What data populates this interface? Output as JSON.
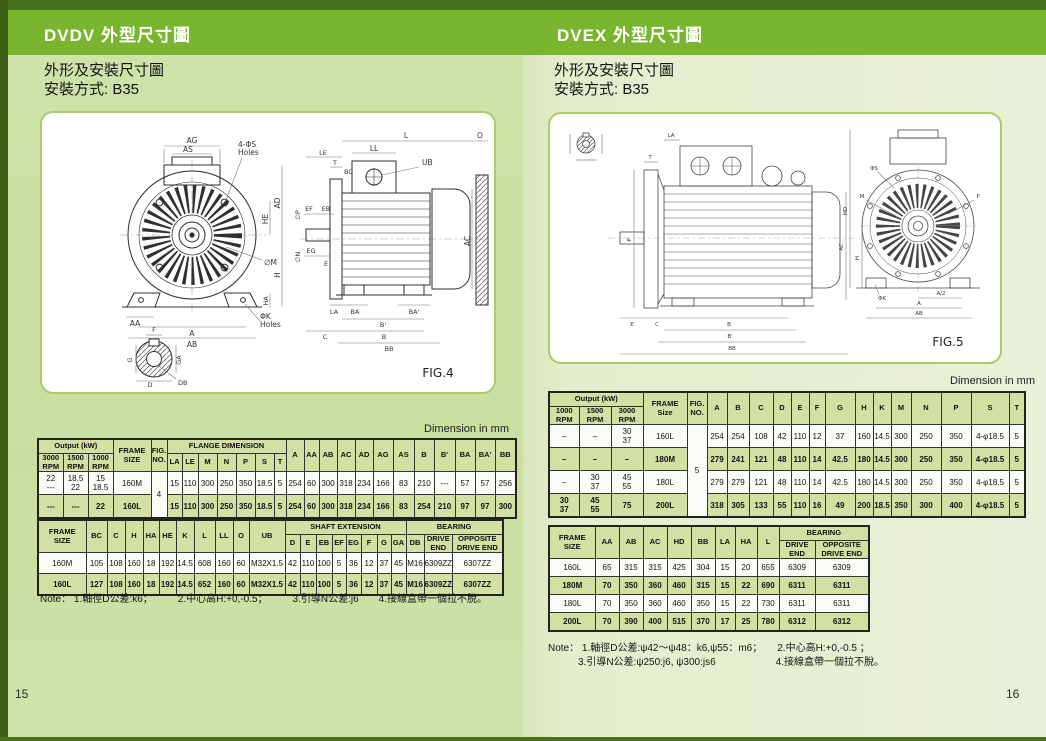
{
  "page_left": {
    "tab_title": "DVDV  外型尺寸圖",
    "subtitle_line1": "外形及安裝尺寸圖",
    "subtitle_line2": "安裝方式: B35",
    "dimension_unit": "Dimension in mm",
    "page_number": "15",
    "note": "Note： 1.軸徑D公差:k6；　　　2.中心高H:+0,-0.5；　　　3.引導N公差:j6　　4.接線盒帶一個拉不脫。",
    "fig": {
      "caption": "FIG.4",
      "ag": "AG",
      "as": "AS",
      "s_holes1": "4-ΦS",
      "s_holes2": "Holes",
      "he": "HE",
      "ad": "AD",
      "m_dia": "∅M",
      "ha": "HA",
      "h": "H",
      "aa": "AA",
      "a": "A",
      "ab": "AB",
      "k_holes1": "ΦK",
      "k_holes2": "Holes",
      "l": "L",
      "o": "O",
      "ll": "LL",
      "ub": "UB",
      "bc": "BC",
      "le": "LE",
      "t": "T",
      "p_dia": "∅P",
      "n_dia": "∅N",
      "ef": "EF",
      "eb": "EB",
      "eg": "EG",
      "e": "E",
      "ac": "AC",
      "la": "LA",
      "ba": "BA",
      "ba2": "BA'",
      "b2": "B'",
      "b": "B",
      "c": "C",
      "bb": "BB",
      "f": "F",
      "g": "G",
      "ga": "GA",
      "d": "D",
      "db": "DB"
    },
    "table1": {
      "header_rows": [
        [
          {
            "t": "Output (kW)",
            "cs": 3
          },
          {
            "t": "FRAME\nSIZE",
            "rs": 2
          },
          {
            "t": "FIG.\nNO.",
            "rs": 2
          },
          {
            "t": "FLANGE DIMENSION",
            "cs": 7
          },
          {
            "t": "A",
            "rs": 2
          },
          {
            "t": "AA",
            "rs": 2
          },
          {
            "t": "AB",
            "rs": 2
          },
          {
            "t": "AC",
            "rs": 2
          },
          {
            "t": "AD",
            "rs": 2
          },
          {
            "t": "AG",
            "rs": 2
          },
          {
            "t": "AS",
            "rs": 2
          },
          {
            "t": "B",
            "rs": 2
          },
          {
            "t": "B'",
            "rs": 2
          },
          {
            "t": "BA",
            "rs": 2
          },
          {
            "t": "BA'",
            "rs": 2
          },
          {
            "t": "BB",
            "rs": 2
          }
        ],
        [
          {
            "t": "3000\nRPM"
          },
          {
            "t": "1500\nRPM"
          },
          {
            "t": "1000\nRPM"
          },
          {
            "t": "LA"
          },
          {
            "t": "LE"
          },
          {
            "t": "M"
          },
          {
            "t": "N"
          },
          {
            "t": "P"
          },
          {
            "t": "S"
          },
          {
            "t": "T"
          }
        ]
      ],
      "rows": [
        {
          "shade": false,
          "cells": [
            "22\n---",
            "18.5\n22",
            "15\n18.5",
            "160M",
            {
              "t": "4",
              "rs": 2
            },
            "15",
            "110",
            "300",
            "250",
            "350",
            "18.5",
            "5",
            "254",
            "60",
            "300",
            "318",
            "234",
            "166",
            "83",
            "210",
            "---",
            "57",
            "57",
            "256"
          ]
        },
        {
          "shade": true,
          "cells": [
            "---",
            "---",
            "22",
            "160L",
            "15",
            "110",
            "300",
            "250",
            "350",
            "18.5",
            "5",
            "254",
            "60",
            "300",
            "318",
            "234",
            "166",
            "83",
            "254",
            "210",
            "97",
            "97",
            "300"
          ]
        }
      ]
    },
    "table2": {
      "header_rows": [
        [
          {
            "t": "FRAME\nSIZE",
            "rs": 2
          },
          {
            "t": "BC",
            "rs": 2
          },
          {
            "t": "C",
            "rs": 2
          },
          {
            "t": "H",
            "rs": 2
          },
          {
            "t": "HA",
            "rs": 2
          },
          {
            "t": "HE",
            "rs": 2
          },
          {
            "t": "K",
            "rs": 2
          },
          {
            "t": "L",
            "rs": 2
          },
          {
            "t": "LL",
            "rs": 2
          },
          {
            "t": "O",
            "rs": 2
          },
          {
            "t": "UB",
            "rs": 2
          },
          {
            "t": "SHAFT  EXTENSION",
            "cs": 8
          },
          {
            "t": "BEARING",
            "cs": 3
          }
        ],
        [
          {
            "t": "D"
          },
          {
            "t": "E"
          },
          {
            "t": "EB"
          },
          {
            "t": "EF"
          },
          {
            "t": "EG"
          },
          {
            "t": "F"
          },
          {
            "t": "G"
          },
          {
            "t": "GA"
          },
          {
            "t": "DB"
          },
          {
            "t": "DRIVE\nEND"
          },
          {
            "t": "OPPOSITE\nDRIVE  END"
          }
        ]
      ],
      "rows": [
        {
          "shade": false,
          "cells": [
            "160M",
            "105",
            "108",
            "160",
            "18",
            "192",
            "14.5",
            "608",
            "160",
            "60",
            "M32X1.5",
            "42",
            "110",
            "100",
            "5",
            "36",
            "12",
            "37",
            "45",
            "M16",
            "6309ZZ",
            "6307ZZ"
          ]
        },
        {
          "shade": true,
          "cells": [
            "160L",
            "127",
            "108",
            "160",
            "18",
            "192",
            "14.5",
            "652",
            "160",
            "60",
            "M32X1.5",
            "42",
            "110",
            "100",
            "5",
            "36",
            "12",
            "37",
            "45",
            "M16",
            "6309ZZ",
            "6307ZZ"
          ]
        }
      ]
    }
  },
  "page_right": {
    "tab_title": "DVEX  外型尺寸圖",
    "subtitle_line1": "外形及安裝尺寸圖",
    "subtitle_line2": "安裝方式: B35",
    "dimension_unit": "Dimension in mm",
    "page_number": "16",
    "note": "Note： 1.軸徑D公差:ψ42～ψ48：k6,ψ55：m6；　　2.中心高H:+0,-0.5 ；\n　　　3.引導N公差:ψ250:j6, ψ300:js6　　　　　　4.接線盒帶一個拉不脫。",
    "fig": {
      "caption": "FIG.5",
      "t": "T",
      "la": "LA",
      "p": "P",
      "ac": "AC",
      "e": "E",
      "c": "C",
      "b": "B",
      "b2": "B'",
      "bb": "BB",
      "l": "L",
      "s_dia": "ΦS",
      "m": "M",
      "p2": "P",
      "hd": "HD",
      "h": "H",
      "k_dia": "ΦK",
      "a_half": "A/2",
      "a": "A",
      "ab": "AB"
    },
    "table1": {
      "header_rows": [
        [
          {
            "t": "Output (kW)",
            "cs": 3
          },
          {
            "t": "FRAME\nSize",
            "rs": 2
          },
          {
            "t": "FIG.\nNO.",
            "rs": 2
          },
          {
            "t": "A",
            "rs": 2
          },
          {
            "t": "B",
            "rs": 2
          },
          {
            "t": "C",
            "rs": 2
          },
          {
            "t": "D",
            "rs": 2
          },
          {
            "t": "E",
            "rs": 2
          },
          {
            "t": "F",
            "rs": 2
          },
          {
            "t": "G",
            "rs": 2
          },
          {
            "t": "H",
            "rs": 2
          },
          {
            "t": "K",
            "rs": 2
          },
          {
            "t": "M",
            "rs": 2
          },
          {
            "t": "N",
            "rs": 2
          },
          {
            "t": "P",
            "rs": 2
          },
          {
            "t": "S",
            "rs": 2
          },
          {
            "t": "T",
            "rs": 2
          }
        ],
        [
          {
            "t": "1000\nRPM"
          },
          {
            "t": "1500\nRPM"
          },
          {
            "t": "3000\nRPM"
          }
        ]
      ],
      "rows": [
        {
          "shade": false,
          "cells": [
            "–",
            "–",
            "30\n37",
            "160L",
            {
              "t": "5",
              "rs": 4
            },
            "254",
            "254",
            "108",
            "42",
            "110",
            "12",
            "37",
            "160",
            "14.5",
            "300",
            "250",
            "350",
            "4-φ18.5",
            "5"
          ]
        },
        {
          "shade": true,
          "cells": [
            "–",
            "–",
            "–",
            "180M",
            "279",
            "241",
            "121",
            "48",
            "110",
            "14",
            "42.5",
            "180",
            "14.5",
            "300",
            "250",
            "350",
            "4-φ18.5",
            "5"
          ]
        },
        {
          "shade": false,
          "cells": [
            "–",
            "30\n37",
            "45\n55",
            "180L",
            "279",
            "279",
            "121",
            "48",
            "110",
            "14",
            "42.5",
            "180",
            "14.5",
            "300",
            "250",
            "350",
            "4-φ18.5",
            "5"
          ]
        },
        {
          "shade": true,
          "cells": [
            "30\n37",
            "45\n55",
            "75",
            "200L",
            "318",
            "305",
            "133",
            "55",
            "110",
            "16",
            "49",
            "200",
            "18.5",
            "350",
            "300",
            "400",
            "4-φ18.5",
            "5"
          ]
        }
      ]
    },
    "table2": {
      "header_rows": [
        [
          {
            "t": "FRAME\nSIZE",
            "rs": 2
          },
          {
            "t": "AA",
            "rs": 2
          },
          {
            "t": "AB",
            "rs": 2
          },
          {
            "t": "AC",
            "rs": 2
          },
          {
            "t": "HD",
            "rs": 2
          },
          {
            "t": "BB",
            "rs": 2
          },
          {
            "t": "LA",
            "rs": 2
          },
          {
            "t": "HA",
            "rs": 2
          },
          {
            "t": "L",
            "rs": 2
          },
          {
            "t": "BEARING",
            "cs": 2
          }
        ],
        [
          {
            "t": "DRIVE\nEND"
          },
          {
            "t": "OPPOSITE\nDRIVE END"
          }
        ]
      ],
      "rows": [
        {
          "shade": false,
          "cells": [
            "160L",
            "65",
            "315",
            "315",
            "425",
            "304",
            "15",
            "20",
            "655",
            "6309",
            "6309"
          ]
        },
        {
          "shade": true,
          "cells": [
            "180M",
            "70",
            "350",
            "360",
            "460",
            "315",
            "15",
            "22",
            "690",
            "6311",
            "6311"
          ]
        },
        {
          "shade": false,
          "cells": [
            "180L",
            "70",
            "350",
            "360",
            "460",
            "350",
            "15",
            "22",
            "730",
            "6311",
            "6311"
          ]
        },
        {
          "shade": true,
          "cells": [
            "200L",
            "70",
            "390",
            "400",
            "515",
            "370",
            "17",
            "25",
            "780",
            "6312",
            "6312"
          ]
        }
      ]
    }
  }
}
